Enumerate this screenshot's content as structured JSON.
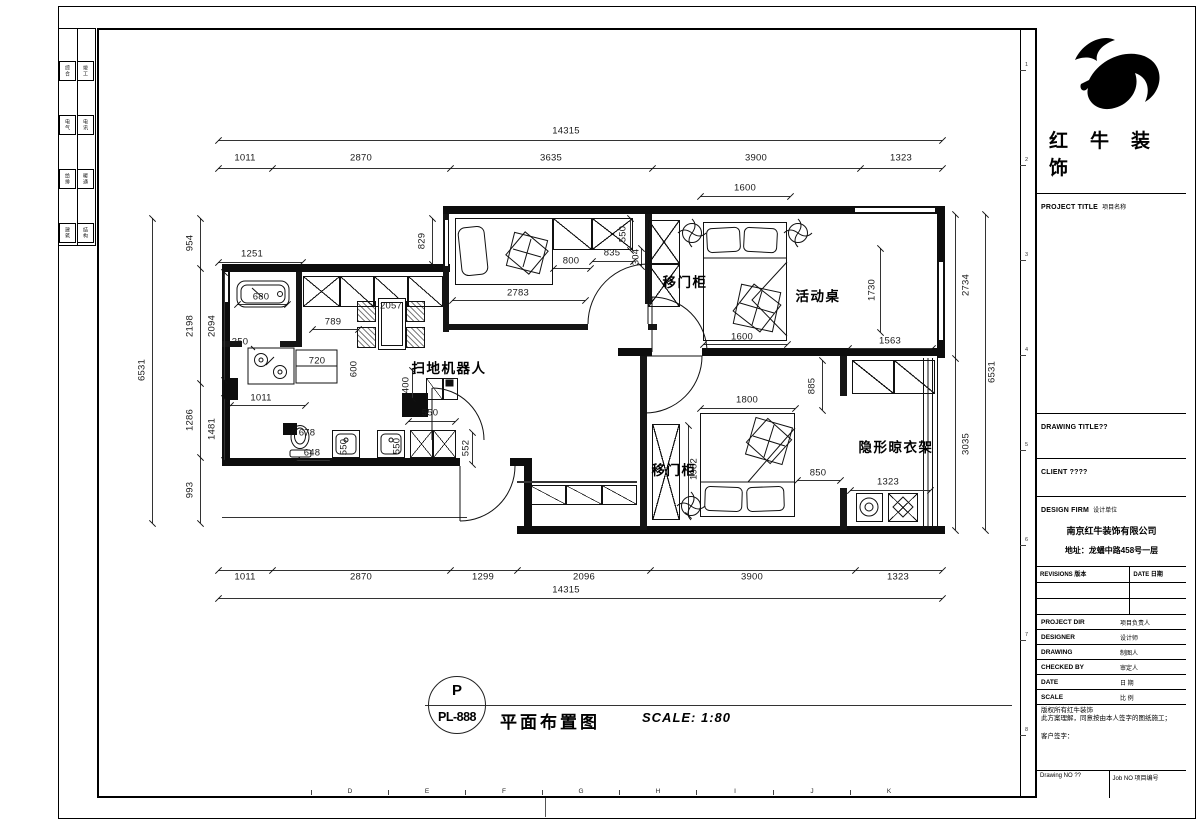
{
  "sheet": {
    "grid_letters": [
      "D",
      "E",
      "F",
      "G",
      "H",
      "I",
      "J",
      "K"
    ],
    "grid_numbers": [
      "1",
      "2",
      "3",
      "4",
      "5",
      "6",
      "7",
      "8"
    ],
    "side_strip_rows": [
      [
        "综合",
        "竣工"
      ],
      [
        "电气",
        "电讯"
      ],
      [
        "给排",
        "暖通"
      ],
      [
        "建筑",
        "结构"
      ]
    ]
  },
  "title_block": {
    "company": "红牛装饰",
    "project_title_en": "PROJECT TITLE",
    "project_title_cn": "项目名称",
    "drawing_title_en": "DRAWING TITLE??",
    "client_en": "CLIENT ????",
    "design_firm_en": "DESIGN FIRM",
    "design_firm_cn": "设计单位",
    "firm_name": "南京红牛装饰有限公司",
    "firm_address": "地址：龙蟠中路458号一层",
    "revisions_label": "REVISIONS 版本",
    "date_label": "DATE 日期",
    "rows": [
      {
        "en": "PROJECT DIR",
        "cn": "项目负责人"
      },
      {
        "en": "DESIGNER",
        "cn": "设计师"
      },
      {
        "en": "DRAWING",
        "cn": "制图人"
      },
      {
        "en": "CHECKED BY",
        "cn": "审定人"
      },
      {
        "en": "DATE",
        "cn": "日 期"
      },
      {
        "en": "SCALE",
        "cn": "比 例"
      }
    ],
    "copyright_line1": "版权所有红牛装饰",
    "copyright_line2": "此方案理解，同意按由本人签字的图纸施工；",
    "customer_sign": "客户签字：",
    "drawing_no": "Drawing NO ??",
    "job_no": "Job NO 项目编号"
  },
  "figure": {
    "mark_top": "P",
    "mark_bottom": "PL-888",
    "title": "平面布置图",
    "scale": "SCALE: 1:80"
  },
  "plan": {
    "room_labels": [
      {
        "t": "扫地机器人",
        "x": 449,
        "y": 367
      },
      {
        "t": "移门柜",
        "x": 685,
        "y": 281
      },
      {
        "t": "活动桌",
        "x": 818,
        "y": 295
      },
      {
        "t": "移门柜",
        "x": 674,
        "y": 469
      },
      {
        "t": "隐形晾衣架",
        "x": 896,
        "y": 446
      }
    ],
    "dimensions": [
      {
        "t": "14315",
        "x": 566,
        "y": 131
      },
      {
        "t": "1011",
        "x": 245,
        "y": 158
      },
      {
        "t": "2870",
        "x": 361,
        "y": 158
      },
      {
        "t": "3635",
        "x": 551,
        "y": 158
      },
      {
        "t": "3900",
        "x": 756,
        "y": 158
      },
      {
        "t": "1323",
        "x": 901,
        "y": 158
      },
      {
        "t": "1600",
        "x": 745,
        "y": 188
      },
      {
        "t": "954",
        "x": 190,
        "y": 243,
        "r": 1
      },
      {
        "t": "2198",
        "x": 190,
        "y": 326,
        "r": 1
      },
      {
        "t": "1286",
        "x": 190,
        "y": 420,
        "r": 1
      },
      {
        "t": "993",
        "x": 190,
        "y": 490,
        "r": 1
      },
      {
        "t": "6531",
        "x": 142,
        "y": 370,
        "r": 1
      },
      {
        "t": "2094",
        "x": 212,
        "y": 326,
        "r": 1
      },
      {
        "t": "1481",
        "x": 212,
        "y": 429,
        "r": 1
      },
      {
        "t": "1251",
        "x": 252,
        "y": 254
      },
      {
        "t": "829",
        "x": 422,
        "y": 241,
        "r": 1
      },
      {
        "t": "800",
        "x": 571,
        "y": 261
      },
      {
        "t": "835",
        "x": 612,
        "y": 253
      },
      {
        "t": "550",
        "x": 623,
        "y": 234,
        "r": 1
      },
      {
        "t": "304",
        "x": 636,
        "y": 257,
        "r": 1
      },
      {
        "t": "2783",
        "x": 518,
        "y": 293
      },
      {
        "t": "2057",
        "x": 391,
        "y": 306
      },
      {
        "t": "789",
        "x": 333,
        "y": 322
      },
      {
        "t": "680",
        "x": 261,
        "y": 297
      },
      {
        "t": "350",
        "x": 240,
        "y": 342
      },
      {
        "t": "720",
        "x": 317,
        "y": 361
      },
      {
        "t": "600",
        "x": 354,
        "y": 369,
        "r": 1
      },
      {
        "t": "1011",
        "x": 261,
        "y": 398
      },
      {
        "t": "400",
        "x": 406,
        "y": 385,
        "r": 1
      },
      {
        "t": "550",
        "x": 430,
        "y": 413
      },
      {
        "t": "678",
        "x": 307,
        "y": 433
      },
      {
        "t": "648",
        "x": 312,
        "y": 453
      },
      {
        "t": "550",
        "x": 344,
        "y": 447,
        "r": 1
      },
      {
        "t": "550",
        "x": 397,
        "y": 446,
        "r": 1
      },
      {
        "t": "552",
        "x": 466,
        "y": 448,
        "r": 1
      },
      {
        "t": "1600",
        "x": 742,
        "y": 337
      },
      {
        "t": "1730",
        "x": 872,
        "y": 290,
        "r": 1
      },
      {
        "t": "2734",
        "x": 966,
        "y": 285,
        "r": 1
      },
      {
        "t": "1563",
        "x": 890,
        "y": 341
      },
      {
        "t": "6531",
        "x": 992,
        "y": 372,
        "r": 1
      },
      {
        "t": "3035",
        "x": 966,
        "y": 444,
        "r": 1
      },
      {
        "t": "885",
        "x": 812,
        "y": 386,
        "r": 1
      },
      {
        "t": "1800",
        "x": 747,
        "y": 400
      },
      {
        "t": "1982",
        "x": 694,
        "y": 469,
        "r": 1
      },
      {
        "t": "850",
        "x": 818,
        "y": 473
      },
      {
        "t": "1323",
        "x": 888,
        "y": 482
      },
      {
        "t": "1011",
        "x": 245,
        "y": 577
      },
      {
        "t": "2870",
        "x": 361,
        "y": 577
      },
      {
        "t": "1299",
        "x": 483,
        "y": 577
      },
      {
        "t": "2096",
        "x": 584,
        "y": 577
      },
      {
        "t": "3900",
        "x": 752,
        "y": 577
      },
      {
        "t": "1323",
        "x": 898,
        "y": 577
      },
      {
        "t": "14315",
        "x": 566,
        "y": 590
      }
    ]
  }
}
